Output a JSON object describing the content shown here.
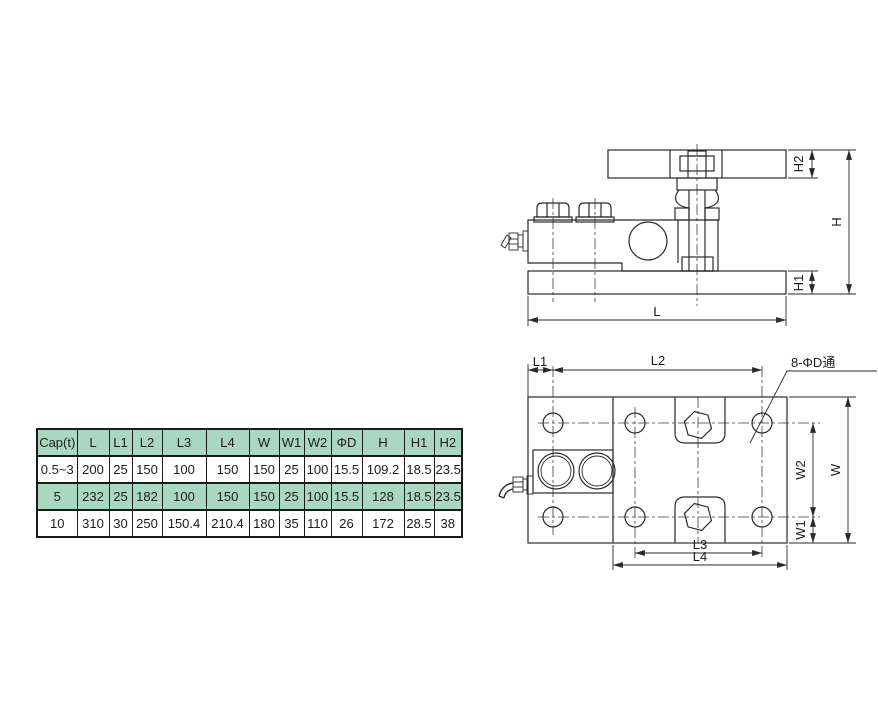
{
  "title": "Load cell mounting module dimension drawing",
  "colors": {
    "line": "#2a2a2a",
    "table_green": "#aad7bf"
  },
  "table": {
    "headers": [
      "Cap(t)",
      "L",
      "L1",
      "L2",
      "L3",
      "L4",
      "W",
      "W1",
      "W2",
      "ΦD",
      "H",
      "H1",
      "H2"
    ],
    "rows": [
      {
        "highlight": false,
        "cells": [
          "0.5~3",
          "200",
          "25",
          "150",
          "100",
          "150",
          "150",
          "25",
          "100",
          "15.5",
          "109.2",
          "18.5",
          "23.5"
        ]
      },
      {
        "highlight": true,
        "cells": [
          "5",
          "232",
          "25",
          "182",
          "100",
          "150",
          "150",
          "25",
          "100",
          "15.5",
          "128",
          "18.5",
          "23.5"
        ]
      },
      {
        "highlight": false,
        "cells": [
          "10",
          "310",
          "30",
          "250",
          "150.4",
          "210.4",
          "180",
          "35",
          "110",
          "26",
          "172",
          "28.5",
          "38"
        ]
      }
    ]
  },
  "dims": {
    "L": "L",
    "L1": "L1",
    "L2": "L2",
    "L3": "L3",
    "L4": "L4",
    "W": "W",
    "W1": "W1",
    "W2": "W2",
    "H": "H",
    "H1": "H1",
    "H2": "H2",
    "holes_note": "8-ΦD通"
  }
}
